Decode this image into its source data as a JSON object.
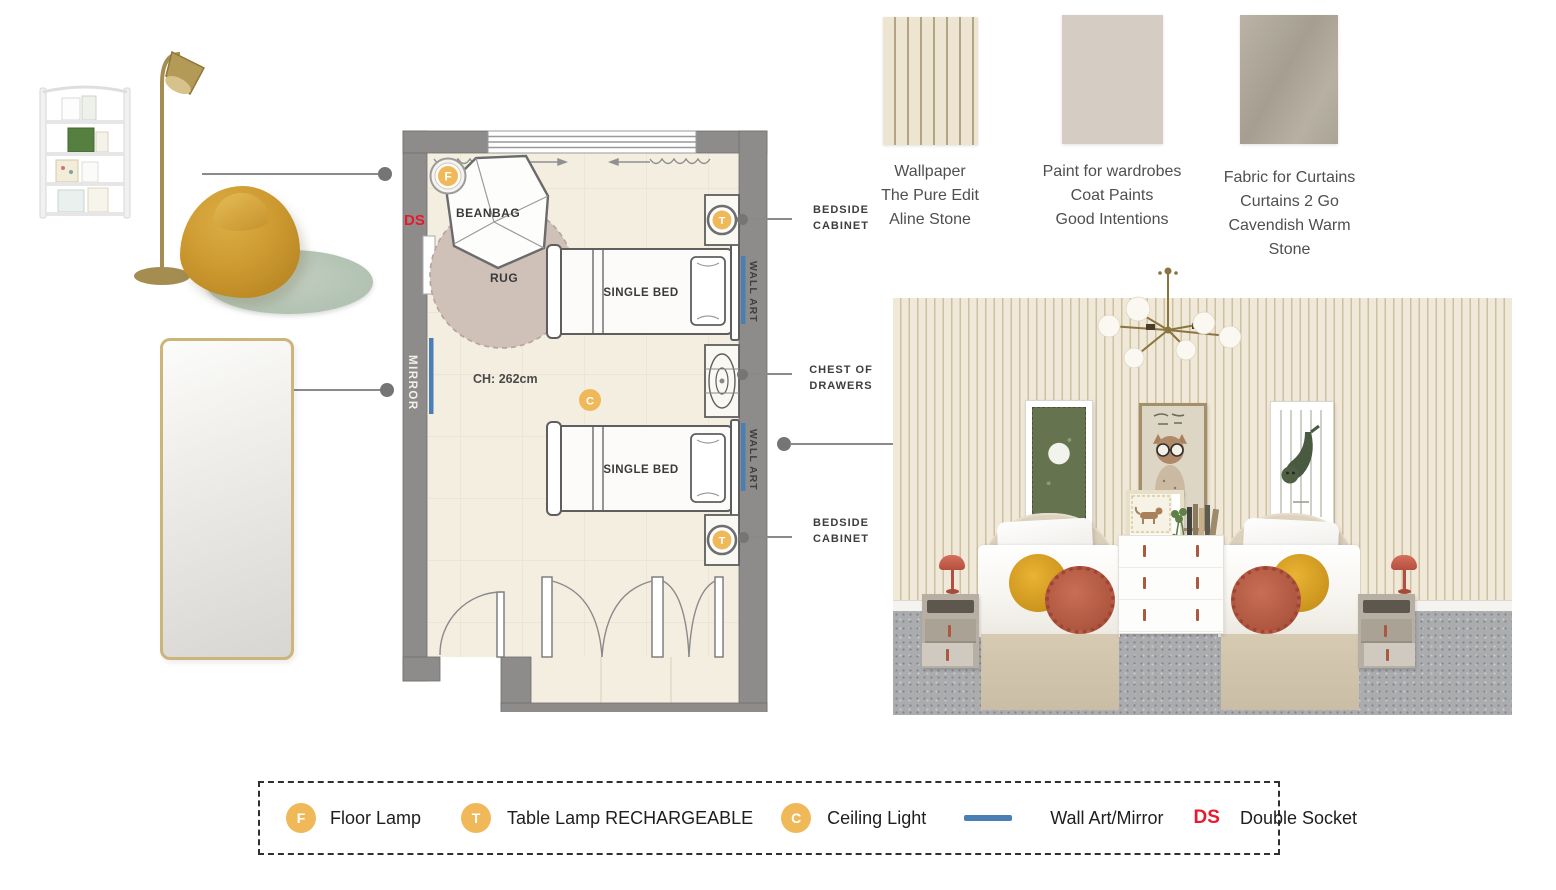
{
  "plan": {
    "labels": {
      "double_socket": "DS",
      "beanbag": "BEANBAG",
      "rug": "RUG",
      "mirror": "MIRROR",
      "ceiling_height": "CH: 262cm",
      "single_bed_1": "SINGLE BED",
      "single_bed_2": "SINGLE BED",
      "wall_art_1": "WALL ART",
      "wall_art_2": "WALL ART"
    },
    "icons": {
      "floor_lamp": "F",
      "table_lamp": "T",
      "ceiling_light": "C"
    }
  },
  "callouts": {
    "bedside_top": {
      "line1": "BEDSIDE",
      "line2": "CABINET"
    },
    "chest": {
      "line1": "CHEST OF",
      "line2": "DRAWERS"
    },
    "bedside_bottom": {
      "line1": "BEDSIDE",
      "line2": "CABINET"
    }
  },
  "swatches": [
    {
      "id": "wallpaper",
      "caption": [
        "Wallpaper",
        "The Pure Edit",
        "Aline Stone"
      ]
    },
    {
      "id": "paint",
      "caption": [
        "Paint for wardrobes",
        "Coat Paints",
        "Good Intentions"
      ]
    },
    {
      "id": "fabric",
      "caption": [
        "Fabric for Curtains",
        "Curtains 2 Go",
        "Cavendish Warm",
        "Stone"
      ]
    }
  ],
  "legend": {
    "items": [
      {
        "symbol": "F",
        "label": "Floor Lamp"
      },
      {
        "symbol": "T",
        "label": "Table Lamp RECHARGEABLE"
      },
      {
        "symbol": "C",
        "label": "Ceiling Light"
      },
      {
        "symbol": "",
        "label": "Wall Art/Mirror"
      },
      {
        "symbol": "DS",
        "label": "Double Socket"
      }
    ]
  },
  "colors": {
    "accent_orange": "#EFB959",
    "accent_blue": "#4A7FB5",
    "accent_red": "#E8192C",
    "wall_gray": "#8E8C8A",
    "floor_cream": "#F4EEE1",
    "wallpaper_beige": "#EDE5D2",
    "paint_beige": "#D5CDC3",
    "fabric_taupe": "#B3ADA0",
    "beanbag_mustard": "#CD9A30",
    "rug_sage": "#B4C4B4"
  }
}
